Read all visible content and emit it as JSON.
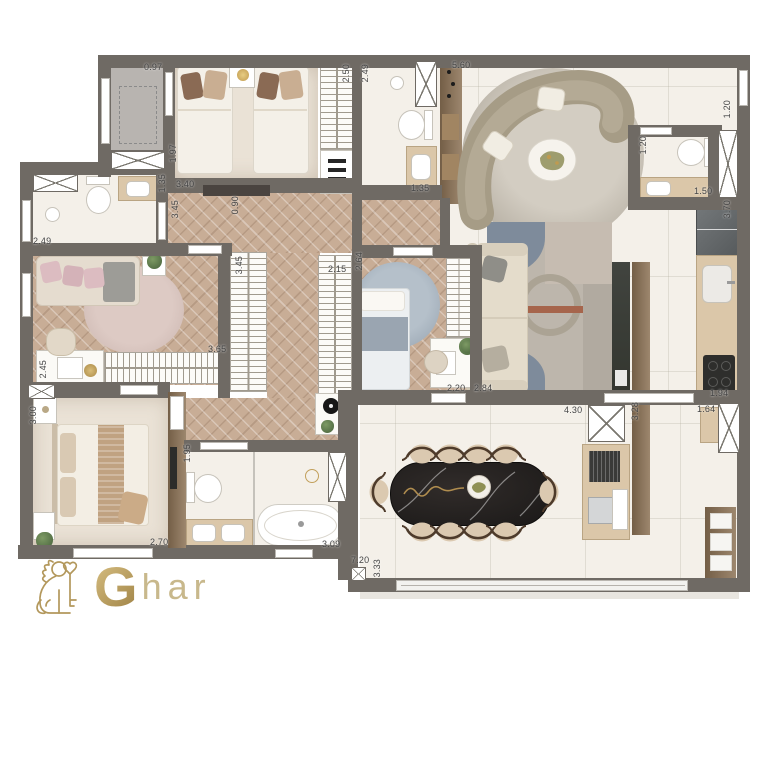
{
  "logo": {
    "g": "G",
    "suffix": "har"
  },
  "colors": {
    "wall": "#6f6a64",
    "wood_floor": "#c8ad96",
    "marble_floor": "#f4f0e9",
    "carpet": "#eae2d6",
    "wood_panel": "#8d7356",
    "counter": "#dbc7a9",
    "dining_table": "#211e1d",
    "rug_blue": "#7e8b9b",
    "rug_rust": "#a6654c",
    "logo_gold": "#b3985c"
  },
  "dim_labels": [
    {
      "text": "0.97",
      "x": 144,
      "y": 62,
      "rot": 0
    },
    {
      "text": "2.50",
      "x": 341,
      "y": 64,
      "rot": 1
    },
    {
      "text": "2.49",
      "x": 360,
      "y": 64,
      "rot": 1
    },
    {
      "text": "5.60",
      "x": 452,
      "y": 60,
      "rot": 0
    },
    {
      "text": "1.20",
      "x": 722,
      "y": 100,
      "rot": 1
    },
    {
      "text": "1.20",
      "x": 638,
      "y": 136,
      "rot": 1
    },
    {
      "text": "1.50",
      "x": 694,
      "y": 186,
      "rot": 0
    },
    {
      "text": "3.70",
      "x": 722,
      "y": 200,
      "rot": 1
    },
    {
      "text": "1.97",
      "x": 168,
      "y": 144,
      "rot": 1
    },
    {
      "text": "1.35",
      "x": 157,
      "y": 174,
      "rot": 1
    },
    {
      "text": "3.40",
      "x": 176,
      "y": 179,
      "rot": 0
    },
    {
      "text": "3.45",
      "x": 170,
      "y": 200,
      "rot": 1
    },
    {
      "text": "0.90",
      "x": 230,
      "y": 196,
      "rot": 1
    },
    {
      "text": "2.49",
      "x": 33,
      "y": 236,
      "rot": 0
    },
    {
      "text": "1.35",
      "x": 411,
      "y": 183,
      "rot": 0
    },
    {
      "text": "3.45",
      "x": 234,
      "y": 256,
      "rot": 1
    },
    {
      "text": "2.15",
      "x": 328,
      "y": 264,
      "rot": 0
    },
    {
      "text": "2.64",
      "x": 354,
      "y": 252,
      "rot": 1
    },
    {
      "text": "3.65",
      "x": 208,
      "y": 344,
      "rot": 0
    },
    {
      "text": "2.45",
      "x": 38,
      "y": 360,
      "rot": 1
    },
    {
      "text": "3.00",
      "x": 28,
      "y": 406,
      "rot": 1
    },
    {
      "text": "2.70",
      "x": 150,
      "y": 537,
      "rot": 0
    },
    {
      "text": "1.95",
      "x": 182,
      "y": 444,
      "rot": 1
    },
    {
      "text": "3.09",
      "x": 322,
      "y": 539,
      "rot": 0
    },
    {
      "text": "7.20",
      "x": 351,
      "y": 555,
      "rot": 0
    },
    {
      "text": "3.33",
      "x": 372,
      "y": 559,
      "rot": 1
    },
    {
      "text": "2.20",
      "x": 447,
      "y": 383,
      "rot": 0
    },
    {
      "text": "2.84",
      "x": 474,
      "y": 383,
      "rot": 0
    },
    {
      "text": "4.30",
      "x": 564,
      "y": 405,
      "rot": 0
    },
    {
      "text": "3.28",
      "x": 630,
      "y": 402,
      "rot": 1
    },
    {
      "text": "1.64",
      "x": 697,
      "y": 404,
      "rot": 0
    },
    {
      "text": "1.94",
      "x": 710,
      "y": 388,
      "rot": 0
    }
  ]
}
